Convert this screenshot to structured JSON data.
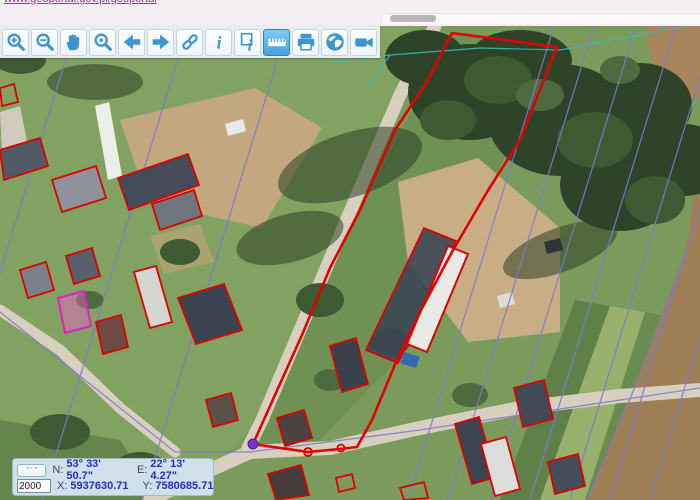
{
  "topbar": {
    "link_text": "www.geoportal.gov.pl/geoportal",
    "scrollbar": "horizontal-scrollbar"
  },
  "toolbar": {
    "buttons": [
      {
        "name": "zoom-in",
        "icon": "magnifier-plus-icon",
        "active": false
      },
      {
        "name": "zoom-out",
        "icon": "magnifier-minus-icon",
        "active": false
      },
      {
        "name": "pan",
        "icon": "hand-icon",
        "active": false
      },
      {
        "name": "zoom-window",
        "icon": "magnifier-icon",
        "active": false
      },
      {
        "name": "previous-view",
        "icon": "arrow-left-icon",
        "active": false
      },
      {
        "name": "next-view",
        "icon": "arrow-right-icon",
        "active": false
      },
      {
        "name": "link",
        "icon": "chain-icon",
        "active": false
      },
      {
        "name": "info",
        "icon": "info-icon",
        "active": false
      },
      {
        "name": "identify",
        "icon": "identify-icon",
        "active": false
      },
      {
        "name": "measure",
        "icon": "ruler-icon",
        "active": true
      },
      {
        "name": "print",
        "icon": "printer-icon",
        "active": false
      },
      {
        "name": "web-services",
        "icon": "globe-icon",
        "active": false
      },
      {
        "name": "video",
        "icon": "video-camera-icon",
        "active": false
      }
    ]
  },
  "coords_panel": {
    "units_button_label": "° ' \"",
    "scale_value": "2000",
    "n_label": "N:",
    "n_value": "53° 33' 50.7\"",
    "e_label": "E:",
    "e_value": "22° 13' 4.27\"",
    "x_label": "X:",
    "x_value": "5937630.71",
    "y_label": "Y:",
    "y_value": "7580685.71"
  },
  "map": {
    "type": "aerial-orthophoto",
    "overlays": {
      "parcel_outline_color": "#e10000",
      "building_outline_color": "#dd0000",
      "highlighted_building_color": "#e020c0",
      "cadastral_line_color": "#7d7ad0",
      "utility_line_color": "#39b8b8",
      "vertex_marker_color": "#7733cc",
      "segment_marker_color": "#e10000"
    }
  },
  "colors": {
    "toolbar_icon": "#3d96cf",
    "toolbar_active_bg": "#55b1e6",
    "panel_bg": "#cfe0eb",
    "value_text": "#2330cc",
    "link_text": "#a233a2"
  }
}
